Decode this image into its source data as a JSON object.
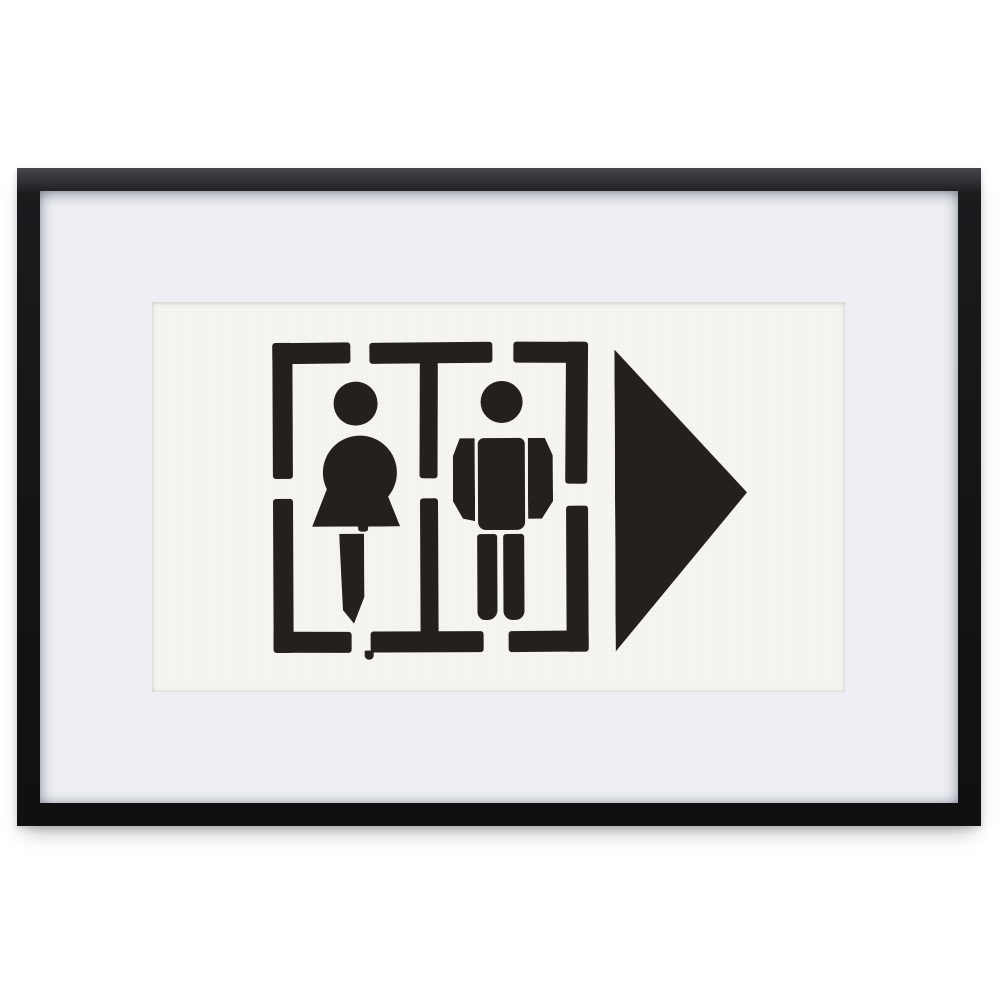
{
  "scene": {
    "description": "Product photo of a matte black picture frame with a white mat board, hung on a white wall, containing a black ink stencil print of a restroom sign: a woman figure and a man figure inside a dashed stencil border, with a large solid arrow pointing right."
  },
  "colors": {
    "background": "#ffffff",
    "frame": "#1b1b1e",
    "frame_highlight": "#47474c",
    "mat": "#edeff4",
    "paper": "#f6f5f0",
    "ink": "#23201e"
  },
  "icons": {
    "woman_figure": "css-shape (circle head, bell-shaped dress, tapered leg)",
    "man_figure": "css-shape (circle head, rectangular torso, detached arm strips, two legs)",
    "arrow_right": "css-triangle pointing right",
    "stencil_border": "dashed rectangular stencil frame with center divider"
  }
}
